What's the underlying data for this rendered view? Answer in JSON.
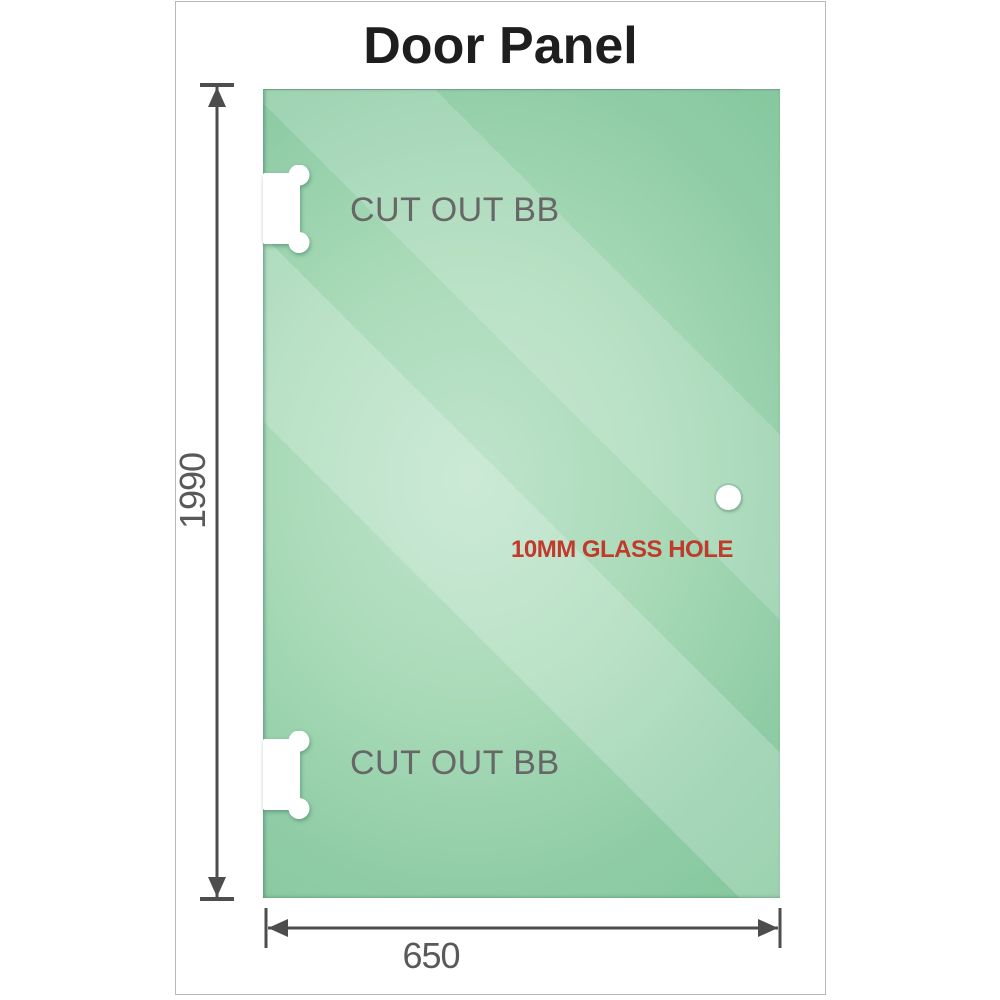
{
  "title": {
    "text": "Door Panel",
    "color": "#1e1e1e"
  },
  "panel": {
    "glass_color_dark": "#83c69c",
    "glass_color_light": "#bfe4cc",
    "cutout_top": {
      "label": "CUT OUT BB"
    },
    "cutout_bottom": {
      "label": "CUT OUT BB"
    },
    "hole": {
      "label": "10MM GLASS HOLE",
      "label_color": "#c13a2b"
    }
  },
  "dimensions": {
    "height": {
      "value": "1990"
    },
    "width": {
      "value": "650"
    },
    "line_color": "#4d4d4d",
    "text_color": "#595959",
    "label_color": "#676767"
  }
}
